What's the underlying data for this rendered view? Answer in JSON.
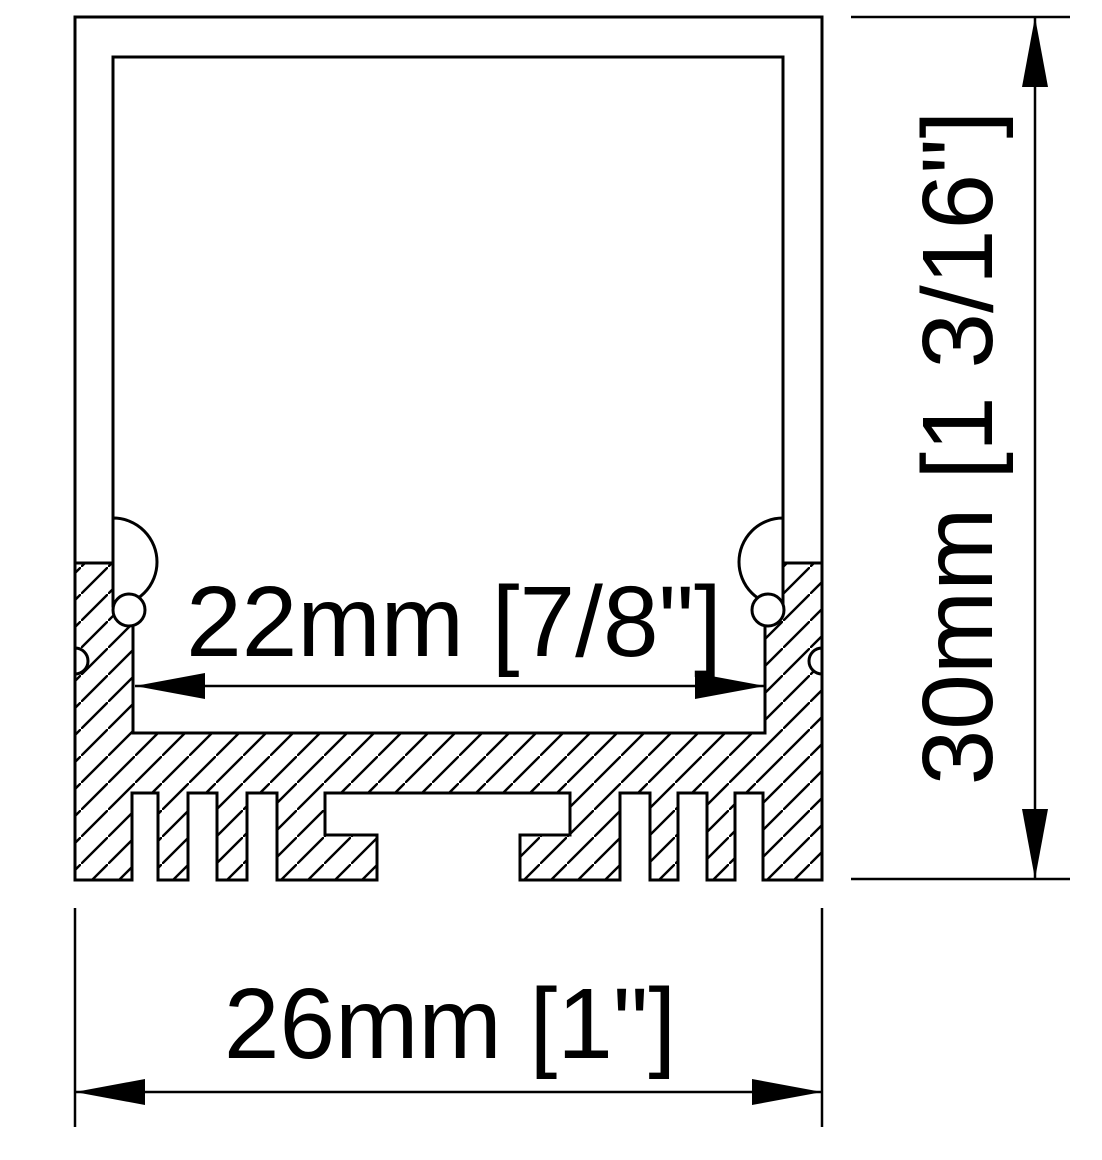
{
  "drawing": {
    "kind": "LED aluminum profile cross-section",
    "dimensions": {
      "channel_inner_width": {
        "label": "22mm [7/8\"]",
        "mm": 22,
        "inches": "7/8\""
      },
      "overall_width": {
        "label": "26mm [1\"]",
        "mm": 26,
        "inches": "1\""
      },
      "overall_height": {
        "label": "30mm [1 3/16\"]",
        "mm": 30,
        "inches": "1 3/16\""
      }
    },
    "colors": {
      "line": "#000000",
      "background": "#ffffff"
    }
  }
}
